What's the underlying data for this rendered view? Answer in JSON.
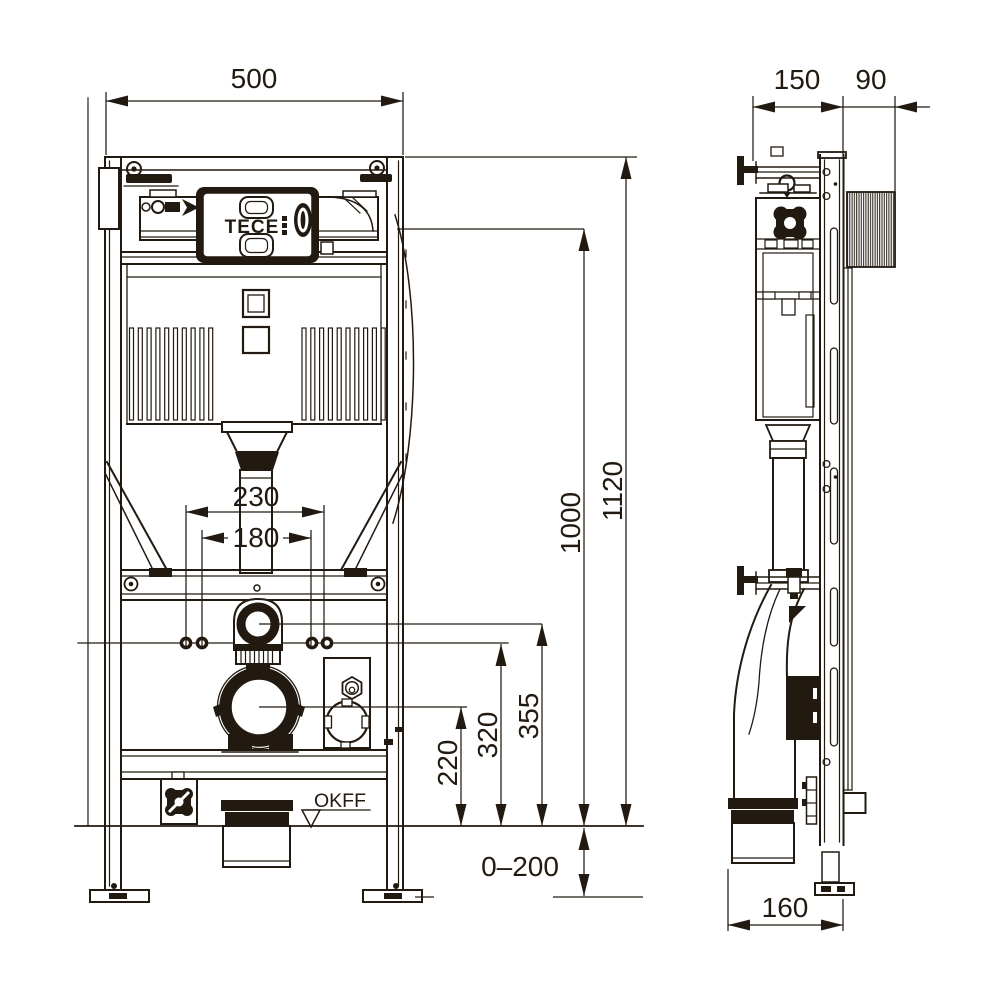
{
  "brand": {
    "name": "TECE"
  },
  "labels": {
    "floor_level": "OKFF"
  },
  "dims": {
    "front": {
      "width": "500",
      "fixing_outer": "230",
      "fixing_inner": "180",
      "height_total": "1120",
      "height_panel": "1000",
      "height_flush_bend": "355",
      "height_fixing": "320",
      "height_outlet": "220",
      "foot_adjustment": "0–200"
    },
    "side": {
      "depth_frame": "150",
      "depth_top_rail": "90",
      "outlet_offset": "160"
    }
  }
}
